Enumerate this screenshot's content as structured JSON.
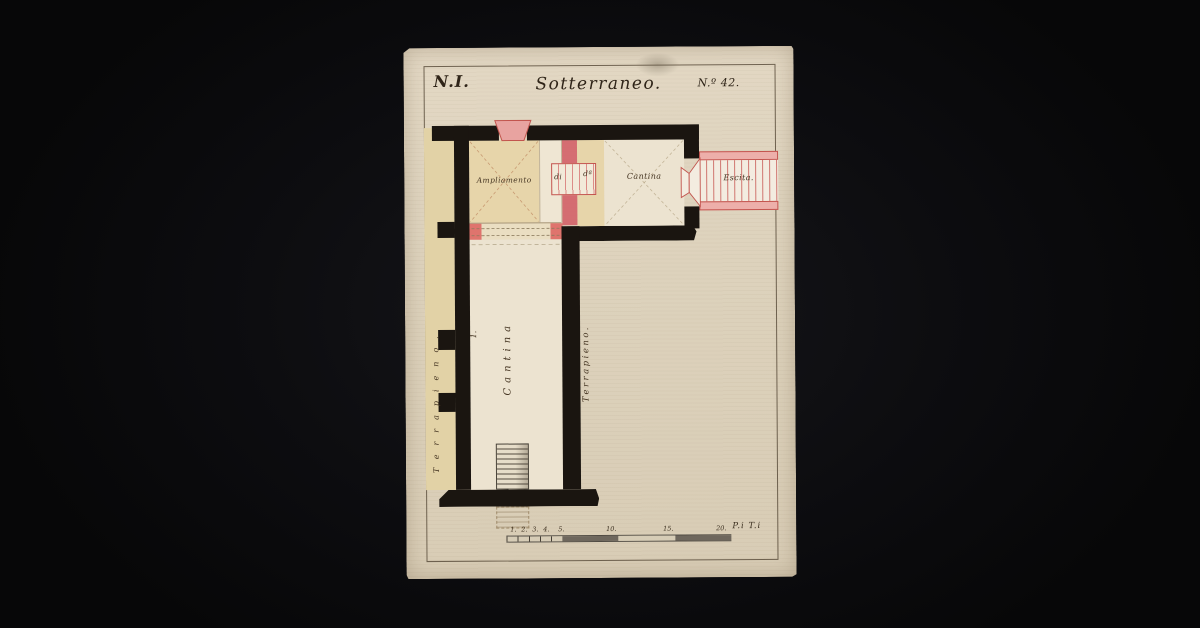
{
  "sheet": {
    "header": {
      "left_number": "N.I.",
      "title": "Sotterraneo.",
      "right_number": "N.º 42."
    },
    "plan": {
      "ampliamento_label": "Ampliamento",
      "ampliamento_label2": "di",
      "ampliamento_label3": "dª",
      "cantina_top_label": "Cantina",
      "exit_label": "Escita.",
      "long_room_number": "1.",
      "long_room_label": "Cantina",
      "terrapieno_right_label": "Terrapieno.",
      "terrapieno_left_label": "Terrapieno."
    },
    "scale_bar": {
      "ticks": [
        "1.",
        "2.",
        "3.",
        "4.",
        "5."
      ],
      "majors": [
        "10.",
        "15.",
        "20."
      ],
      "unit": "P.i T.i"
    },
    "colors": {
      "ink": "#1a1510",
      "accent_red": "#c4554f",
      "pink": "#e8a3a0",
      "paper": "#ddd2bb",
      "tan": "#e2d2a6",
      "cream": "#ece3d0",
      "background": "#0d0d10"
    }
  }
}
